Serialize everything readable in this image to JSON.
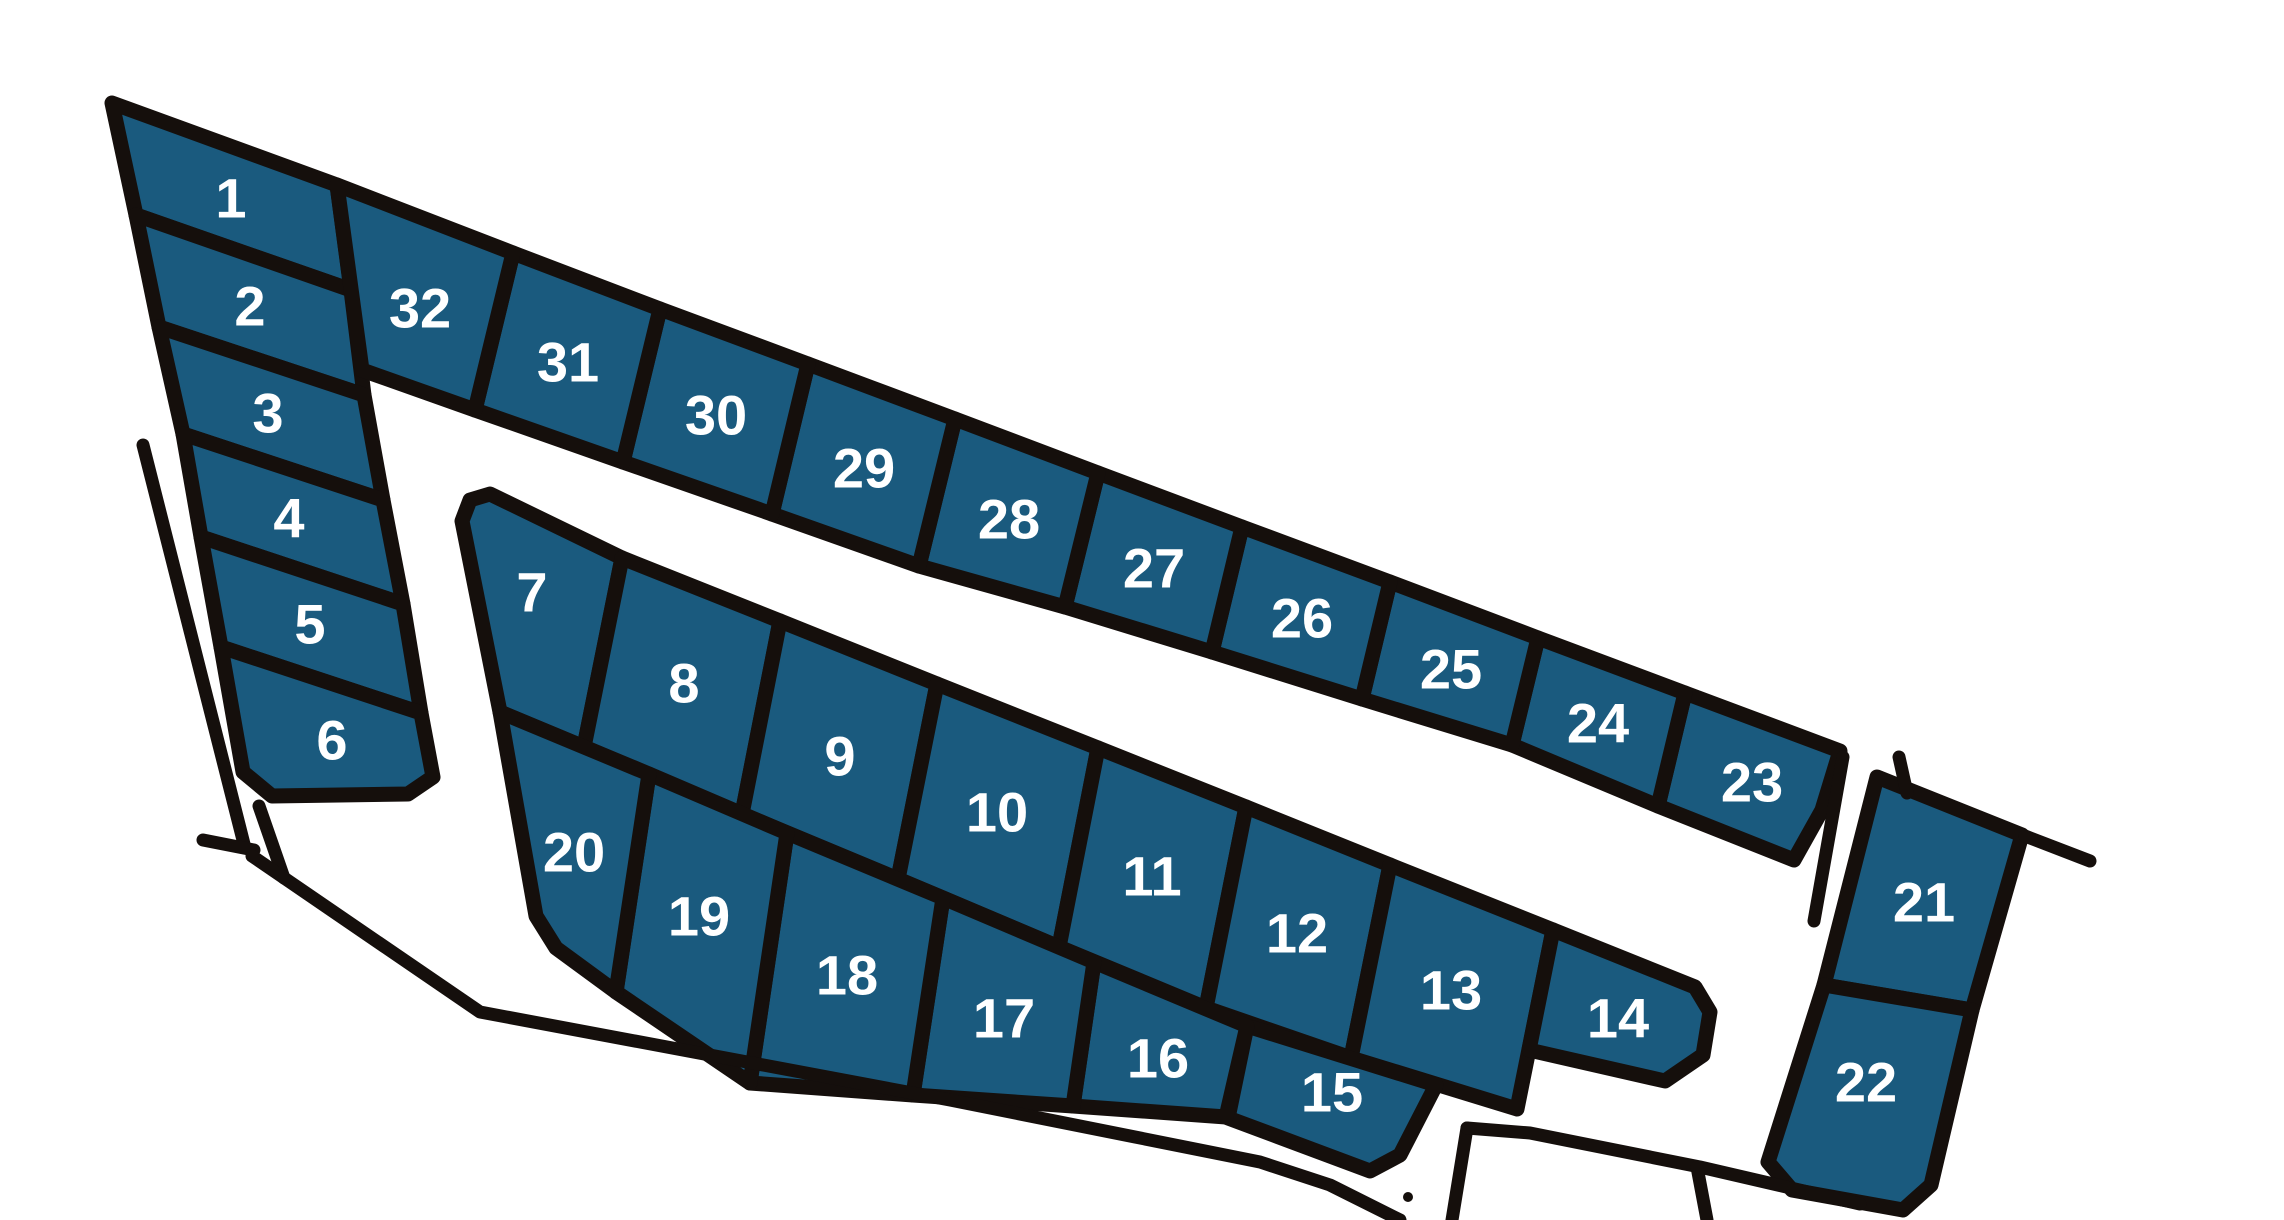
{
  "canvas": {
    "width": 2284,
    "height": 1220,
    "background": "#ffffff"
  },
  "style": {
    "lot_fill": "#1a5a7e",
    "line_color": "#150f0c",
    "lot_stroke_width": 15,
    "road_stroke_width": 13,
    "label_color": "#ffffff",
    "label_font_size": 56
  },
  "map": {
    "title": "Subdivision plat map with 32 numbered lots",
    "lots": [
      {
        "number": "1",
        "points": "112,103 337,185 351,290 136,215",
        "label_x": 231,
        "label_y": 198
      },
      {
        "number": "2",
        "points": "136,215 351,290 364,395 159,327",
        "label_x": 250,
        "label_y": 306
      },
      {
        "number": "3",
        "points": "159,327 364,395 383,500 183,434",
        "label_x": 268,
        "label_y": 413
      },
      {
        "number": "4",
        "points": "183,434 383,500 403,604 201,537",
        "label_x": 289,
        "label_y": 518
      },
      {
        "number": "5",
        "points": "201,537 403,604 421,713 221,647",
        "label_x": 310,
        "label_y": 624
      },
      {
        "number": "6",
        "points": "221,647 421,713 433,777 408,794 272,796 243,772",
        "label_x": 332,
        "label_y": 740
      },
      {
        "number": "7",
        "points": "462,521 470,500 490,494 622,558 584,747 500,712",
        "label_x": 532,
        "label_y": 592
      },
      {
        "number": "8",
        "points": "622,558 780,621 742,814 584,747",
        "label_x": 684,
        "label_y": 683
      },
      {
        "number": "9",
        "points": "780,621 937,684 898,879 742,814",
        "label_x": 840,
        "label_y": 756
      },
      {
        "number": "10",
        "points": "937,684 1098,748 1059,947 898,879",
        "label_x": 997,
        "label_y": 812
      },
      {
        "number": "11",
        "points": "1098,748 1246,807 1206,1008 1059,947",
        "label_x": 1152,
        "label_y": 876
      },
      {
        "number": "12",
        "points": "1246,807 1390,865 1351,1058 1206,1008",
        "label_x": 1297,
        "label_y": 933
      },
      {
        "number": "13",
        "points": "1390,865 1553,930 1517,1109 1351,1058",
        "label_x": 1451,
        "label_y": 990
      },
      {
        "number": "14",
        "points": "1553,930 1695,987 1710,1012 1703,1055 1665,1081 1529,1050",
        "label_x": 1618,
        "label_y": 1018
      },
      {
        "number": "15",
        "points": "1247,1026 1436,1085 1400,1155 1370,1171 1228,1118",
        "label_x": 1332,
        "label_y": 1092
      },
      {
        "number": "16",
        "points": "1094,962 1247,1026 1226,1117 1073,1106",
        "label_x": 1158,
        "label_y": 1058
      },
      {
        "number": "17",
        "points": "943,898 1094,962 1073,1106 913,1095",
        "label_x": 1004,
        "label_y": 1018
      },
      {
        "number": "18",
        "points": "787,833 943,898 913,1095 750,1083",
        "label_x": 847,
        "label_y": 975
      },
      {
        "number": "19",
        "points": "649,774 787,833 750,1083 616,992",
        "label_x": 699,
        "label_y": 916
      },
      {
        "number": "20",
        "points": "500,712 649,774 616,992 556,948 536,916",
        "label_x": 574,
        "label_y": 852
      },
      {
        "number": "21",
        "points": "1877,777 2022,835 1972,1010 1824,985",
        "label_x": 1924,
        "label_y": 902
      },
      {
        "number": "22",
        "points": "1824,985 1972,1010 1931,1185 1903,1210 1792,1190 1768,1162",
        "label_x": 1866,
        "label_y": 1082
      },
      {
        "number": "23",
        "points": "1685,693 1840,751 1822,810 1794,860 1658,806",
        "label_x": 1752,
        "label_y": 782
      },
      {
        "number": "24",
        "points": "1538,638 1685,693 1658,806 1512,745",
        "label_x": 1598,
        "label_y": 723
      },
      {
        "number": "25",
        "points": "1390,582 1538,638 1512,745 1362,699",
        "label_x": 1451,
        "label_y": 669
      },
      {
        "number": "26",
        "points": "1242,527 1390,582 1362,699 1212,652",
        "label_x": 1302,
        "label_y": 618
      },
      {
        "number": "27",
        "points": "1098,473 1242,527 1212,652 1065,607",
        "label_x": 1154,
        "label_y": 568
      },
      {
        "number": "28",
        "points": "955,419 1098,473 1065,607 919,566",
        "label_x": 1009,
        "label_y": 519
      },
      {
        "number": "29",
        "points": "808,364 955,419 919,566 772,514",
        "label_x": 864,
        "label_y": 468
      },
      {
        "number": "30",
        "points": "660,309 808,364 772,514 623,462",
        "label_x": 716,
        "label_y": 415
      },
      {
        "number": "31",
        "points": "513,253 660,309 623,462 475,410",
        "label_x": 568,
        "label_y": 362
      },
      {
        "number": "32",
        "points": "337,185 513,253 475,410 362,370",
        "label_x": 420,
        "label_y": 308
      }
    ],
    "roads": [
      {
        "name": "road-left-outer",
        "points": "143,445 245,848"
      },
      {
        "name": "road-stub-sw-a",
        "points": "259,806 284,878"
      },
      {
        "name": "road-stub-sw-b",
        "points": "203,840 254,850"
      },
      {
        "name": "road-bottom-south",
        "points": "252,856 480,1012 950,1100 1260,1162 1330,1185 1400,1220"
      },
      {
        "name": "road-exit-west",
        "points": "1452,1220 1467,1128"
      },
      {
        "name": "road-exit-east",
        "points": "1467,1128 1530,1133 1700,1167 1860,1204"
      },
      {
        "name": "road-exit-stub",
        "points": "1697,1167 1707,1220"
      },
      {
        "name": "road-east-of-23",
        "points": "1843,757 1814,921"
      },
      {
        "name": "road-stub-above-21",
        "points": "1899,757 1907,793"
      },
      {
        "name": "road-ext-from-21",
        "points": "2025,836 2090,861"
      }
    ],
    "markers": [
      {
        "x": 1408,
        "y": 1197,
        "r": 5
      }
    ]
  }
}
